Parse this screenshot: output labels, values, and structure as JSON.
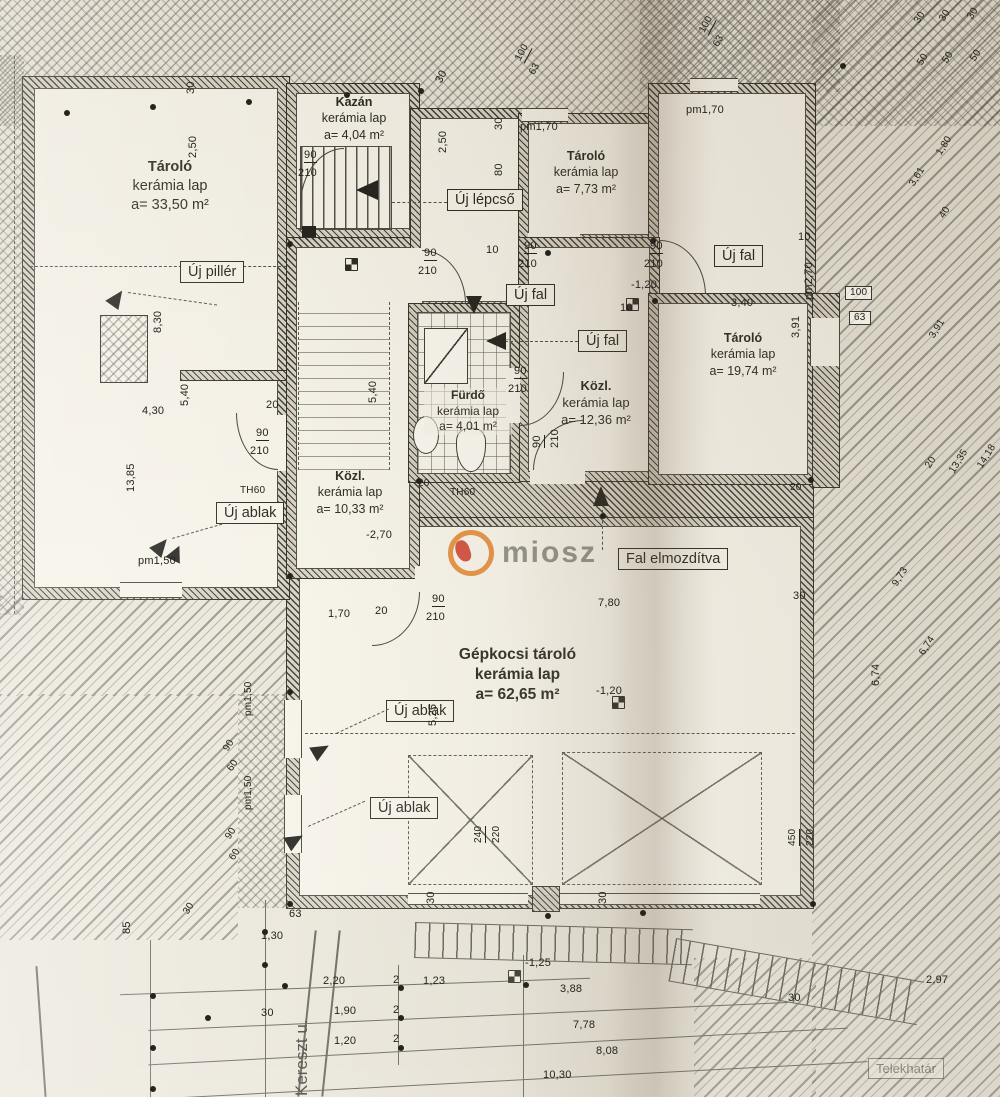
{
  "plan": {
    "watermark": "miosz",
    "street_label": "Kereszt u.",
    "boundary_label": "Telekhatár",
    "rooms": {
      "tarolo_a": {
        "name": "Tároló",
        "material": "kerámia lap",
        "area": "a= 33,50 m²"
      },
      "kazan": {
        "name": "Kazán",
        "material": "kerámia lap",
        "area": "a= 4,04 m²"
      },
      "tarolo_b": {
        "name": "Tároló",
        "material": "kerámia lap",
        "area": "a= 7,73 m²"
      },
      "furdo": {
        "name": "Fürdő",
        "material": "kerámia lap",
        "area": "a= 4,01 m²"
      },
      "kozl_b": {
        "name": "Közl.",
        "material": "kerámia lap",
        "area": "a= 12,36 m²"
      },
      "kozl_a": {
        "name": "Közl.",
        "material": "kerámia lap",
        "area": "a= 10,33 m²"
      },
      "tarolo_c": {
        "name": "Tároló",
        "material": "kerámia lap",
        "area": "a= 19,74 m²"
      },
      "garazs": {
        "name": "Gépkocsi tároló",
        "material": "kerámia lap",
        "area": "a= 62,65 m²"
      }
    },
    "callouts": {
      "uj_lepcso": "Új lépcső",
      "uj_piller": "Új pillér",
      "uj_fal": "Új fal",
      "uj_ablak": "Új ablak",
      "fal_elmozditva": "Fal elmozdítva"
    },
    "dims": [
      {
        "t": "30",
        "x": 186,
        "y": 94,
        "r": -90
      },
      {
        "t": "2,50",
        "x": 188,
        "y": 158,
        "r": -90
      },
      {
        "t": "8,30",
        "x": 153,
        "y": 333,
        "r": -90
      },
      {
        "t": "4,30",
        "x": 142,
        "y": 406
      },
      {
        "t": "5,40",
        "x": 180,
        "y": 406,
        "r": -90
      },
      {
        "t": "20",
        "x": 266,
        "y": 400
      },
      {
        "t": "5,40",
        "x": 368,
        "y": 403,
        "r": -90
      },
      {
        "t": "13,85",
        "x": 126,
        "y": 492,
        "r": -90
      },
      {
        "t": "TH60",
        "x": 240,
        "y": 486,
        "s": 10
      },
      {
        "t": "TH60",
        "x": 450,
        "y": 488,
        "s": 10
      },
      {
        "t": "pm1,50",
        "x": 138,
        "y": 556
      },
      {
        "t": "-2,70",
        "x": 366,
        "y": 530
      },
      {
        "t": "1,70",
        "x": 328,
        "y": 609
      },
      {
        "t": "20",
        "x": 375,
        "y": 606
      },
      {
        "t": "7,80",
        "x": 598,
        "y": 598
      },
      {
        "t": "30",
        "x": 793,
        "y": 591
      },
      {
        "t": "30",
        "x": 434,
        "y": 80,
        "r": -62
      },
      {
        "t": "2,50",
        "x": 438,
        "y": 153,
        "r": -90
      },
      {
        "t": "30",
        "x": 494,
        "y": 130,
        "r": -90
      },
      {
        "t": "80",
        "x": 494,
        "y": 176,
        "r": -90
      },
      {
        "t": "pm1,70",
        "x": 520,
        "y": 122
      },
      {
        "t": "pm1,70",
        "x": 686,
        "y": 105
      },
      {
        "t": "10",
        "x": 486,
        "y": 245
      },
      {
        "t": "10",
        "x": 620,
        "y": 303
      },
      {
        "t": "10",
        "x": 798,
        "y": 232
      },
      {
        "t": "-1,20",
        "x": 631,
        "y": 280
      },
      {
        "t": "3,40",
        "x": 731,
        "y": 298
      },
      {
        "t": "3,91",
        "x": 791,
        "y": 338,
        "r": -90
      },
      {
        "t": "pm2,70",
        "x": 804,
        "y": 300,
        "r": -90
      },
      {
        "t": "100",
        "x": 845,
        "y": 286,
        "b": 1,
        "s": 10
      },
      {
        "t": "63",
        "x": 849,
        "y": 311,
        "b": 1,
        "s": 10
      },
      {
        "t": "100",
        "x": 514,
        "y": 58,
        "r": -62,
        "u": 1,
        "s": 10
      },
      {
        "t": "63",
        "x": 528,
        "y": 72,
        "r": -62,
        "s": 10
      },
      {
        "t": "100",
        "x": 698,
        "y": 30,
        "r": -62,
        "u": 1,
        "s": 10
      },
      {
        "t": "63",
        "x": 712,
        "y": 44,
        "r": -62,
        "s": 10
      },
      {
        "t": "30",
        "x": 913,
        "y": 20,
        "r": -58,
        "s": 10
      },
      {
        "t": "50",
        "x": 916,
        "y": 62,
        "r": -58,
        "s": 10
      },
      {
        "t": "30",
        "x": 938,
        "y": 18,
        "r": -58,
        "s": 10
      },
      {
        "t": "50",
        "x": 941,
        "y": 60,
        "r": -58,
        "s": 10
      },
      {
        "t": "30",
        "x": 966,
        "y": 16,
        "r": -58,
        "s": 10
      },
      {
        "t": "50",
        "x": 969,
        "y": 58,
        "r": -58,
        "s": 10
      },
      {
        "t": "1,80",
        "x": 935,
        "y": 152,
        "r": -58,
        "s": 10
      },
      {
        "t": "3,61",
        "x": 908,
        "y": 183,
        "r": -58,
        "s": 10
      },
      {
        "t": "40",
        "x": 938,
        "y": 215,
        "r": -58,
        "s": 10
      },
      {
        "t": "3,91",
        "x": 928,
        "y": 335,
        "r": -58,
        "s": 10
      },
      {
        "t": "20",
        "x": 924,
        "y": 465,
        "r": -58,
        "s": 10
      },
      {
        "t": "13,35",
        "x": 948,
        "y": 470,
        "r": -58,
        "s": 10
      },
      {
        "t": "14,18",
        "x": 976,
        "y": 465,
        "r": -58,
        "s": 10
      },
      {
        "t": "9,73",
        "x": 891,
        "y": 583,
        "r": -58,
        "s": 10
      },
      {
        "t": "6,74",
        "x": 918,
        "y": 652,
        "r": -58,
        "s": 10
      },
      {
        "t": "6,74",
        "x": 871,
        "y": 686,
        "r": -90
      },
      {
        "t": "-1,20",
        "x": 596,
        "y": 686
      },
      {
        "t": "5,25",
        "x": 428,
        "y": 726,
        "r": -90
      },
      {
        "t": "pm1,50",
        "x": 244,
        "y": 716,
        "r": -90,
        "s": 10
      },
      {
        "t": "pm1,50",
        "x": 244,
        "y": 810,
        "r": -90,
        "s": 10
      },
      {
        "t": "90",
        "x": 222,
        "y": 748,
        "r": -58,
        "s": 10
      },
      {
        "t": "60",
        "x": 226,
        "y": 768,
        "r": -58,
        "s": 10
      },
      {
        "t": "90",
        "x": 224,
        "y": 836,
        "r": -58,
        "s": 10
      },
      {
        "t": "60",
        "x": 228,
        "y": 857,
        "r": -58,
        "s": 10
      },
      {
        "t": "30",
        "x": 182,
        "y": 911,
        "r": -58,
        "s": 10
      },
      {
        "t": "85",
        "x": 122,
        "y": 934,
        "r": -90
      },
      {
        "t": "63",
        "x": 289,
        "y": 909
      },
      {
        "t": "1,30",
        "x": 261,
        "y": 931
      },
      {
        "t": "30",
        "x": 426,
        "y": 904,
        "r": -90
      },
      {
        "t": "30",
        "x": 598,
        "y": 904,
        "r": -90
      },
      {
        "t": "2,20",
        "x": 323,
        "y": 976
      },
      {
        "t": "2",
        "x": 393,
        "y": 975
      },
      {
        "t": "1,23",
        "x": 423,
        "y": 976
      },
      {
        "t": "-1,25",
        "x": 525,
        "y": 958
      },
      {
        "t": "3,88",
        "x": 560,
        "y": 984
      },
      {
        "t": "30",
        "x": 261,
        "y": 1008
      },
      {
        "t": "1,90",
        "x": 334,
        "y": 1006
      },
      {
        "t": "2",
        "x": 393,
        "y": 1005
      },
      {
        "t": "1,20",
        "x": 334,
        "y": 1036
      },
      {
        "t": "2",
        "x": 393,
        "y": 1034
      },
      {
        "t": "7,78",
        "x": 573,
        "y": 1020
      },
      {
        "t": "8,08",
        "x": 596,
        "y": 1046
      },
      {
        "t": "10,30",
        "x": 543,
        "y": 1070
      },
      {
        "t": "2,97",
        "x": 926,
        "y": 975
      },
      {
        "t": "30",
        "x": 788,
        "y": 993
      },
      {
        "t": "240",
        "x": 474,
        "y": 843,
        "r": -90,
        "u": 1,
        "s": 10
      },
      {
        "t": "220",
        "x": 492,
        "y": 843,
        "r": -90,
        "s": 10
      },
      {
        "t": "450",
        "x": 788,
        "y": 846,
        "r": -90,
        "u": 1,
        "s": 10
      },
      {
        "t": "220",
        "x": 806,
        "y": 846,
        "r": -90,
        "s": 10
      },
      {
        "t": "90",
        "x": 304,
        "y": 150,
        "u": 1
      },
      {
        "t": "210",
        "x": 298,
        "y": 168
      },
      {
        "t": "90",
        "x": 424,
        "y": 248,
        "u": 1
      },
      {
        "t": "210",
        "x": 418,
        "y": 266
      },
      {
        "t": "90",
        "x": 524,
        "y": 241,
        "u": 1
      },
      {
        "t": "210",
        "x": 518,
        "y": 259
      },
      {
        "t": "90",
        "x": 650,
        "y": 241,
        "u": 1
      },
      {
        "t": "210",
        "x": 644,
        "y": 259
      },
      {
        "t": "90",
        "x": 514,
        "y": 366,
        "u": 1
      },
      {
        "t": "210",
        "x": 508,
        "y": 384
      },
      {
        "t": "90",
        "x": 256,
        "y": 428,
        "u": 1
      },
      {
        "t": "210",
        "x": 250,
        "y": 446
      },
      {
        "t": "90",
        "x": 432,
        "y": 594,
        "u": 1
      },
      {
        "t": "210",
        "x": 426,
        "y": 612
      },
      {
        "t": "90",
        "x": 532,
        "y": 448,
        "r": -90,
        "u": 1
      },
      {
        "t": "210",
        "x": 550,
        "y": 448,
        "r": -90
      },
      {
        "t": "20",
        "x": 418,
        "y": 479,
        "s": 10
      },
      {
        "t": "20",
        "x": 790,
        "y": 483,
        "s": 10
      }
    ]
  }
}
